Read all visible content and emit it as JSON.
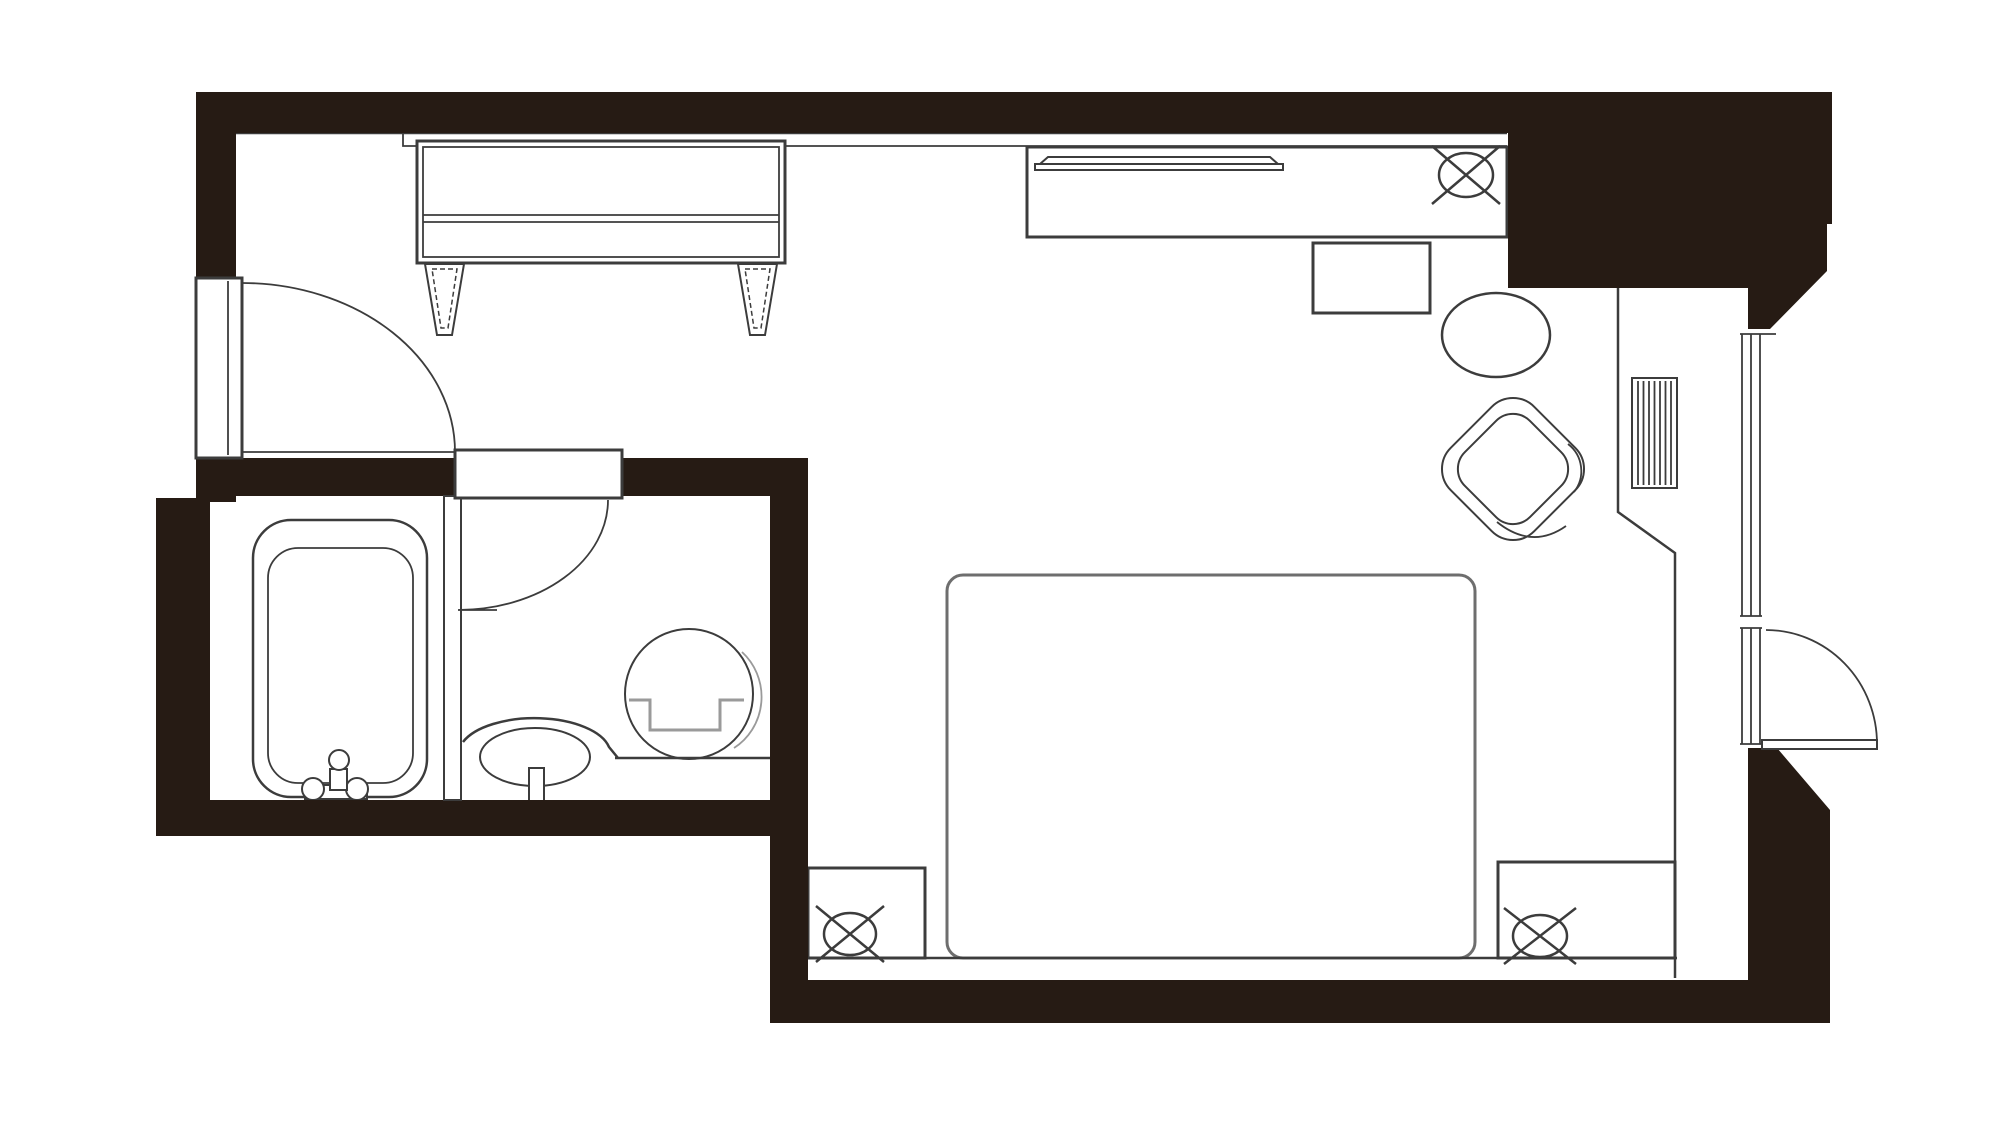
{
  "page": {
    "title": "Room floor plan",
    "type": "architectural floor plan (plan view, monochrome)",
    "visible_text": [],
    "no_visible_text": true
  },
  "colors": {
    "background": "#ffffff",
    "walls": "#261b14",
    "outline": "#3c3c3c",
    "soft_outline": "#6e6e6e",
    "shadow": "#9a9a9a"
  },
  "rooms": [
    {
      "id": "entry-corridor",
      "kind": "entrance corridor"
    },
    {
      "id": "bathtub-room",
      "kind": "bathroom compartment with bathtub"
    },
    {
      "id": "toilet-vanity-room",
      "kind": "toilet and vanity compartment"
    },
    {
      "id": "main-room",
      "kind": "bedroom / living area"
    },
    {
      "id": "window-bay",
      "kind": "window-side counter bay with balcony door"
    }
  ],
  "fixtures": [
    {
      "id": "entrance-door",
      "kind": "hinged door with quarter-circle swing arc"
    },
    {
      "id": "tv-cabinet",
      "kind": "low sideboard with two tapered legs"
    },
    {
      "id": "bathroom-door",
      "kind": "hinged door with quarter-circle swing arc"
    },
    {
      "id": "bathtub",
      "kind": "bathtub with faucet set"
    },
    {
      "id": "vanity-sink",
      "kind": "oval wash basin with faucet"
    },
    {
      "id": "toilet",
      "kind": "toilet with seat/tank line"
    },
    {
      "id": "vanity-shelf-line",
      "kind": "counter line behind toilet"
    },
    {
      "id": "bed",
      "kind": "double bed with rounded corners"
    },
    {
      "id": "nightstand-left",
      "kind": "bedside table"
    },
    {
      "id": "nightstand-right",
      "kind": "bedside table"
    },
    {
      "id": "bedside-lamp-left",
      "kind": "circle-with-X lamp symbol"
    },
    {
      "id": "bedside-lamp-right",
      "kind": "circle-with-X lamp symbol"
    },
    {
      "id": "desk",
      "kind": "long writing desk / console"
    },
    {
      "id": "desk-tray",
      "kind": "thin tray / shelf on desk"
    },
    {
      "id": "desk-lamp",
      "kind": "circle-with-X lamp symbol"
    },
    {
      "id": "luggage-stool",
      "kind": "rectangular stool / luggage rack"
    },
    {
      "id": "round-table",
      "kind": "round side table"
    },
    {
      "id": "armchair",
      "kind": "rotated rounded armchair with cushion"
    },
    {
      "id": "ac-unit",
      "kind": "striped ventilation / radiator box"
    },
    {
      "id": "window",
      "kind": "triple-line window wall with sill break"
    },
    {
      "id": "balcony-door",
      "kind": "outswing door with quarter-circle arc"
    },
    {
      "id": "window-counter-edge",
      "kind": "counter / bay edge line"
    },
    {
      "id": "bed-baseline",
      "kind": "platform line under bed and nightstands"
    }
  ]
}
